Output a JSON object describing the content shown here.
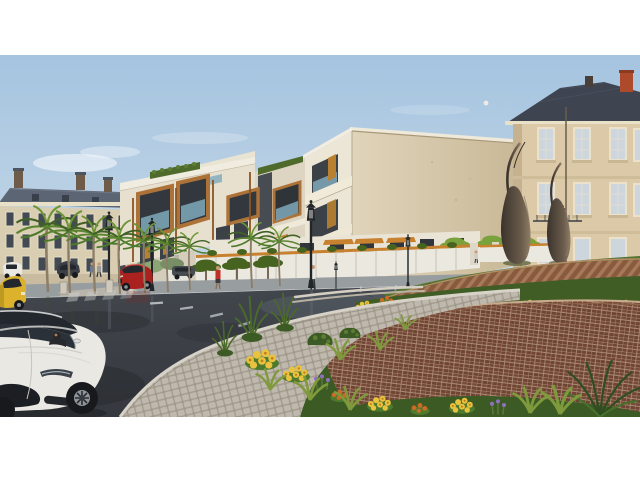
{
  "meta": {
    "description": "3D architectural rendering: modern white-and-wood apartment complex at a landscaped roundabout, flanked by classical European buildings, wet asphalt streets with cars, palm trees, flower terraces of brick, and a dark teardrop sculpture. Letterboxed with white bands top and bottom.",
    "image_type": "architectural-render",
    "letterbox": {
      "top_px": 55,
      "bottom_px": 63,
      "content_height_px": 362
    }
  },
  "palette": {
    "sky_top": "#a5c4e0",
    "sky_mid": "#c3d6e6",
    "sky_horizon": "#e2e1d8",
    "cloud": "#ffffff",
    "moon": "#f3efe6",
    "left_facade": "#d9cdb2",
    "left_roof": "#5c6573",
    "window_dark": "#434a54",
    "window_frame": "#e9e0c8",
    "right_facade": "#dcc9a7",
    "right_roof": "#3e4551",
    "chimney_red": "#ad4a2c",
    "window_glass": "#cdd6dc",
    "modern_white": "#ece6d6",
    "modern_shade": "#ddd5c2",
    "beige_wall": "#e0d4ba",
    "beige_wall_dark": "#c9b998",
    "wood": "#ad7238",
    "wood_dark": "#8a5426",
    "panel_dark": "#3c4148",
    "glass_teal": "#7fa9ba",
    "warm_window": "#b9812f",
    "hedge_green": "#4f6b2c",
    "tree_green": "#46641f",
    "tree_bright": "#7aa23c",
    "grass": "#55752f",
    "shrub_dark": "#3c5a24",
    "leaf_green": "#4e7a2e",
    "fence_white": "#ebe8e0",
    "fence_cap": "#c8812f",
    "sidewalk": "#989da0",
    "median": "#b9b4aa",
    "paver": "#c8c2b7",
    "paver_joint": "#a59e90",
    "curb": "#d8d3c8",
    "asphalt": "#42464d",
    "asphalt_light": "#5d666e",
    "asphalt_dark": "#2c2f34",
    "road_mark": "#cfd3d4",
    "brick_cap": "#8a5a3e",
    "brick_cap_light": "#a57a58",
    "brick_face": "#5e3a28",
    "brick_face_light": "#7a5036",
    "brick_lower": "#6f4433",
    "mortar": "#bca189",
    "flower_yellow": "#e9c23e",
    "flower_center": "#bf7d20",
    "flower_orange": "#cd6a25",
    "flower_purple": "#8f6fbe",
    "sculpture": "#3a332c",
    "sculpture_hi": "#8d7c66",
    "car_white": "#e9e8e3",
    "car_red": "#a92220",
    "car_yellow": "#dcb22c",
    "car_dark": "#3a3f45",
    "glass_dark": "#23282e",
    "tire": "#17191c",
    "rim": "#8f959b",
    "lamp": "#232629",
    "skin": "#c89a74",
    "shirt_red": "#c03028",
    "shirt_white": "#e8e6e0",
    "pants": "#2e3338"
  },
  "scene": {
    "sky": {
      "moon_visible": true,
      "clouds": "thin wisps, left of center"
    },
    "buildings": [
      {
        "id": "building-left",
        "style": "classical, cream facade, slate hip roof, chimneys, 3 window rows"
      },
      {
        "id": "modern-building",
        "style": "contemporary complex: white slabs, orange wood balcony frames, charcoal recesses, teal glass rails, rooftop hedges, blank beige side wall"
      },
      {
        "id": "building-right",
        "style": "classical stone, dark mansard roof, red chimney, tall white-framed windows"
      }
    ],
    "sculpture": {
      "id": "roundabout-sculpture",
      "desc": "two dark bronze teardrop forms with thin curved spires on grassy mound"
    },
    "landscape": {
      "roundabout": "terraced brown brick retaining walls with flower beds (yellow, orange, purple) and grasses",
      "path": "wide curved cobblestone walk between road and gardens",
      "trees": "row of palms along left street, pollarded umbrella trees, bright green trees behind mound, fan palm in bottom-right corner",
      "fence": "white perimeter fence with orange wood cap and planter shrubs"
    },
    "road": {
      "surface": "wet asphalt with reflections",
      "markings": "dashed lane line, faded crosswalk, parking ticks",
      "median": "stone median island with pillars"
    },
    "vehicles": [
      {
        "id": "white-sedan",
        "desc": "white luxury sedan, foreground bottom-left, driver visible through windshield"
      },
      {
        "id": "yellow-hatchback",
        "desc": "yellow hatchback, cropped at left edge"
      },
      {
        "id": "white-minivan",
        "desc": "white minivan parked far left"
      },
      {
        "id": "dark-suv",
        "desc": "dark SUV parked left"
      },
      {
        "id": "distant-dark-car",
        "desc": "dark sedan parked mid-distance"
      },
      {
        "id": "red-crossover",
        "desc": "red crossover driving on cross street"
      }
    ],
    "people": [
      {
        "id": "pedestrian-red-top",
        "desc": "woman in red top on far sidewalk"
      },
      {
        "id": "pedestrian-white-shirt",
        "desc": "man in white shirt on far sidewalk"
      },
      {
        "id": "pedestrian-pair",
        "desc": "two distant pedestrians far left"
      },
      {
        "id": "pedestrian-gate",
        "desc": "pedestrian near gate pillars"
      }
    ]
  }
}
